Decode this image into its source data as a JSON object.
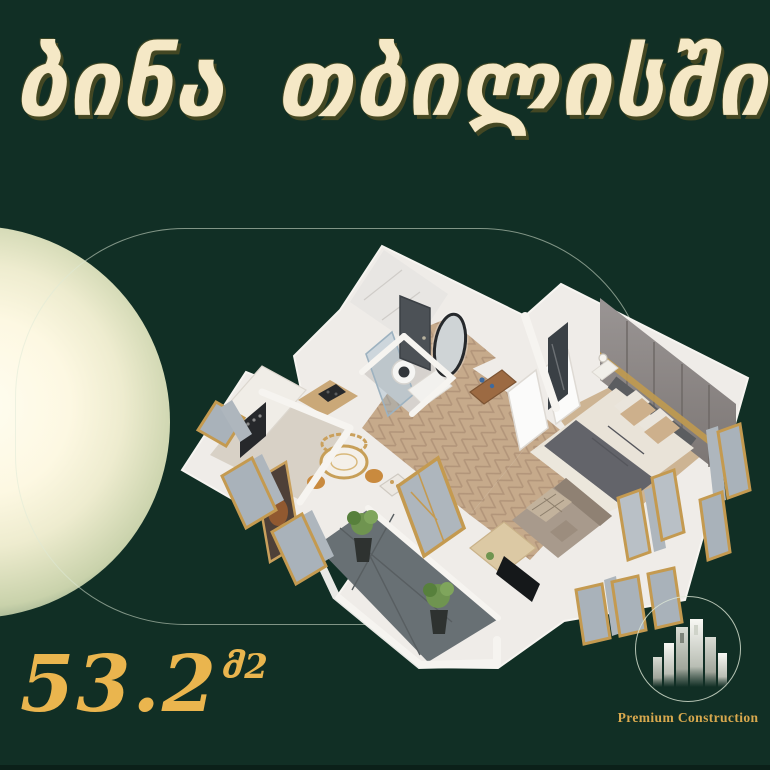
{
  "background": {
    "color": "#112f25"
  },
  "title": {
    "words": [
      "ბინა",
      "თბილისში"
    ],
    "full_text": "ბინა თბილისში",
    "style": "georgian-gold-calligraphy",
    "fill_color": "#f5e8c6",
    "outline_color": "#8a7430"
  },
  "area": {
    "value": "53.2",
    "unit": "მ2",
    "color": "#eab54e"
  },
  "logo": {
    "label": "Premium Construction",
    "icon": "city-buildings-icon",
    "ring_color": "#dfe8da",
    "text_color": "#d9a94e"
  },
  "decor": {
    "gradient_circle": {
      "center_color": "#fffdf0",
      "edge_color": "#9db695"
    },
    "outline_capsule_color": "rgba(223,233,215,0.55)"
  },
  "floor_plan": {
    "type": "isometric-3d-apartment",
    "rooms": [
      "kitchen",
      "bathroom",
      "hallway",
      "bedroom",
      "living-area",
      "balcony"
    ],
    "features": [
      "herringbone-wood-floor",
      "gold-framed-windows",
      "gray-curtains",
      "double-bed",
      "wardrobe",
      "sofa",
      "tv-stand",
      "round-dining-table",
      "oven",
      "washing-machine",
      "oval-mirror",
      "balcony-plants"
    ],
    "colors": {
      "walls": "#efece8",
      "wood_floor": "#c6aa8b",
      "balcony_tile": "#687074",
      "window_frame_gold": "#c49a50",
      "curtain_gray": "#aeb6bd",
      "wardrobe_gray": "#8b8684",
      "bedding_gray": "#63646a",
      "sofa_taupe": "#a89a8c"
    }
  }
}
